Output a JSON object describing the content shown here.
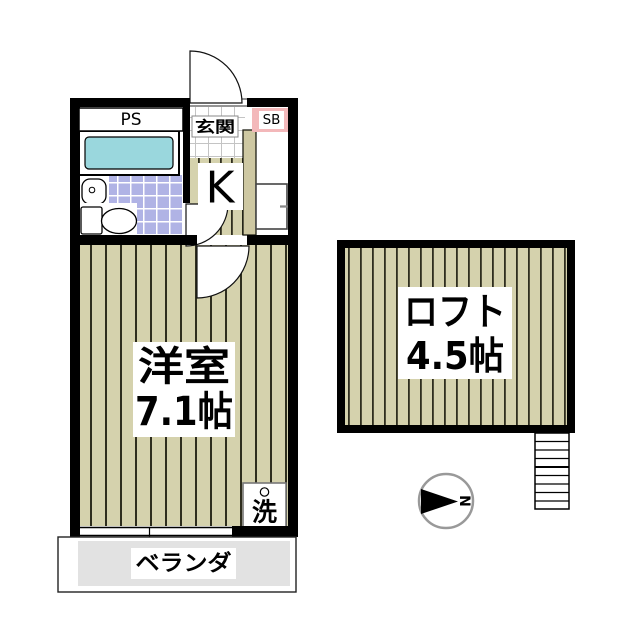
{
  "plan": {
    "unit": {
      "ps_label": "PS",
      "entrance_label": "玄関",
      "shoebox_label": "SB",
      "kitchen_label": "K",
      "room": {
        "name": "洋室",
        "size": "7.1帖"
      },
      "washer_label": "洗",
      "veranda_label": "ベランダ"
    },
    "loft": {
      "name": "ロフト",
      "size": "4.5帖"
    },
    "compass": {
      "north_label": "N"
    },
    "colors": {
      "wall": "#000000",
      "flooring": "#d5d2ad",
      "flooring_line": "#2f2e1e",
      "bath_tile": "#b0b3e5",
      "bathtub": "#9ad7dd",
      "shoebox_pink": "#f3b8ba",
      "entrance_tile_line": "#c4c4c4",
      "veranda_gray": "#e2e2e2"
    }
  }
}
